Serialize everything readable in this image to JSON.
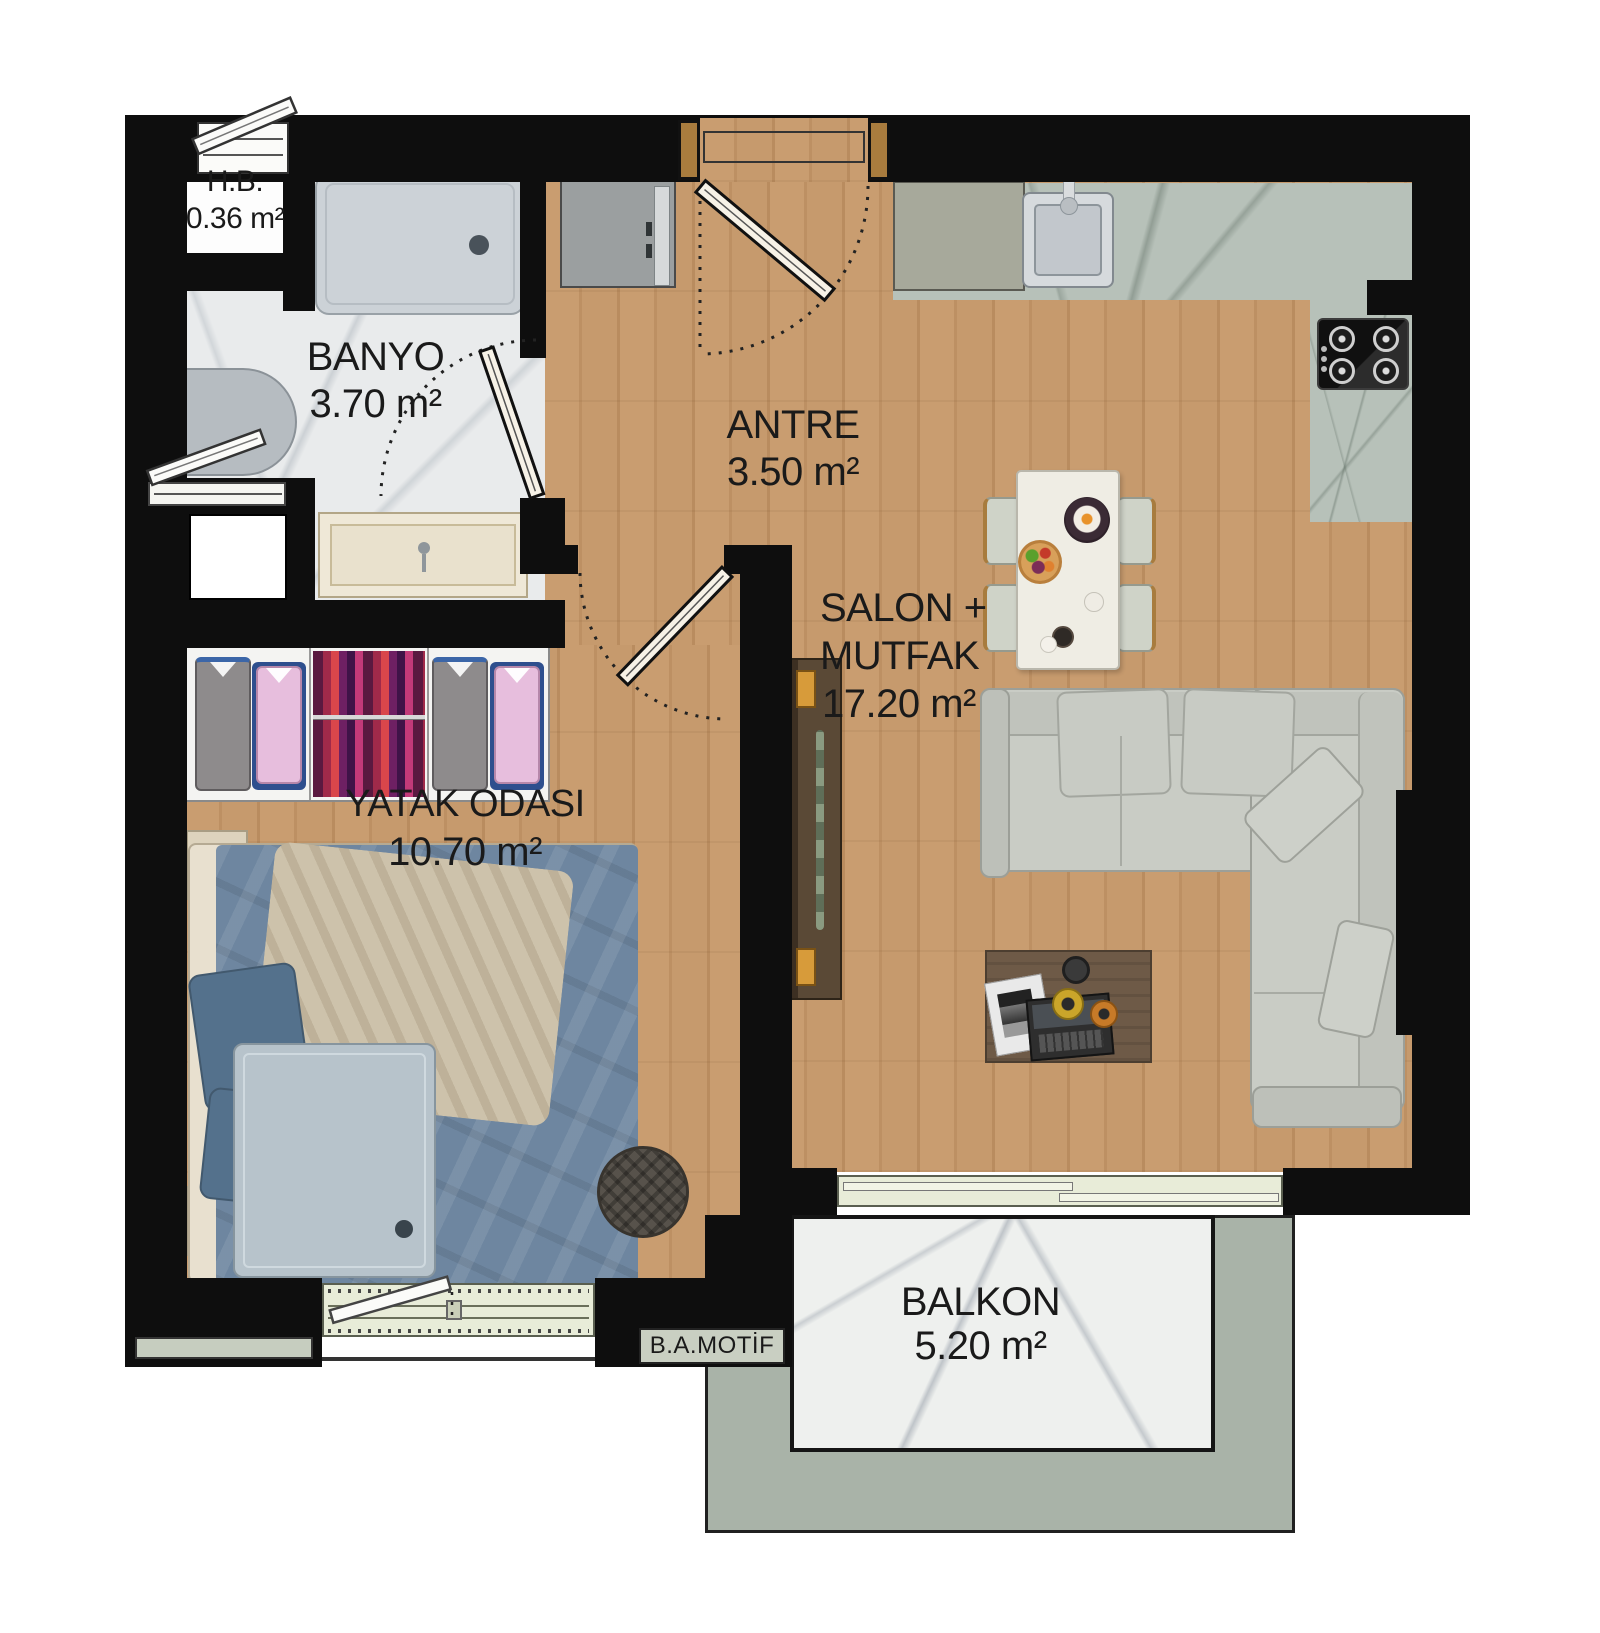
{
  "plan_title": "apartment unit floor plan",
  "rooms": [
    {
      "key": "hb",
      "name": "H.B.",
      "area": "0.36 m²"
    },
    {
      "key": "banyo",
      "name": "BANYO",
      "area": "3.70 m²"
    },
    {
      "key": "antre",
      "name": "ANTRE",
      "area": "3.50 m²"
    },
    {
      "key": "salon",
      "name": "SALON +",
      "name2": "MUTFAK",
      "area": "17.20 m²"
    },
    {
      "key": "yatak",
      "name": "YATAK ODASI",
      "area": "10.70 m²"
    },
    {
      "key": "balkon",
      "name": "BALKON",
      "area": "5.20 m²"
    }
  ],
  "stamp": {
    "label": "B.A.MOTİF"
  },
  "colors": {
    "wall": "#0e0e0e",
    "wood_floor": "#c99d70",
    "bath_marble": "#e9ebec",
    "kitchen_counter": "#b7c1b9",
    "balcony_band": "#a9b3a8",
    "window_frame": "#e8ecd8",
    "sofa": "#c9ccc5",
    "bed_duvet": "#6e86a0"
  }
}
